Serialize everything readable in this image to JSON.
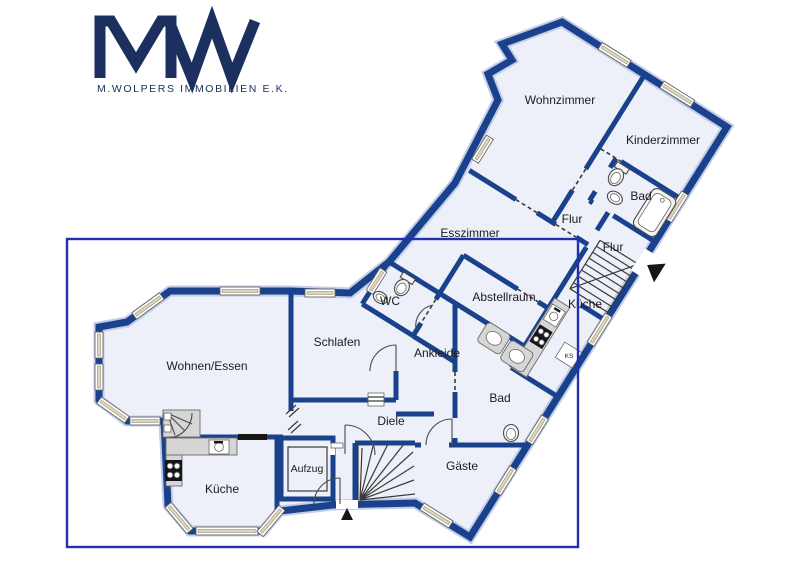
{
  "logo": {
    "monogram": "MW",
    "company": "M.WOLPERS IMMOBILIEN E.K."
  },
  "colors": {
    "wall": "#1a428c",
    "room_fill": "#edf0f8",
    "selection_box": "#2230ae",
    "logo": "#1c3060",
    "window_fill": "#ddd5ba",
    "counter_fill": "#d6d6d6",
    "text": "#1c1c1c"
  },
  "rooms": {
    "upper_wing": {
      "wohnzimmer": "Wohnzimmer",
      "kinderzimmer": "Kinderzimmer",
      "bad": "Bad",
      "flur_a": "Flur",
      "flur_b": "Flur",
      "esszimmer": "Esszimmer",
      "abstellraum": "Abstellraum",
      "kueche": "Küche",
      "wc": "WC"
    },
    "lower_wing": {
      "wohnen_essen": "Wohnen/Essen",
      "schlafen": "Schlafen",
      "ankleide": "Ankleide",
      "diele": "Diele",
      "bad": "Bad",
      "gaeste": "Gäste",
      "aufzug": "Aufzug",
      "kueche": "Küche"
    },
    "appliance_ks": "KS"
  }
}
